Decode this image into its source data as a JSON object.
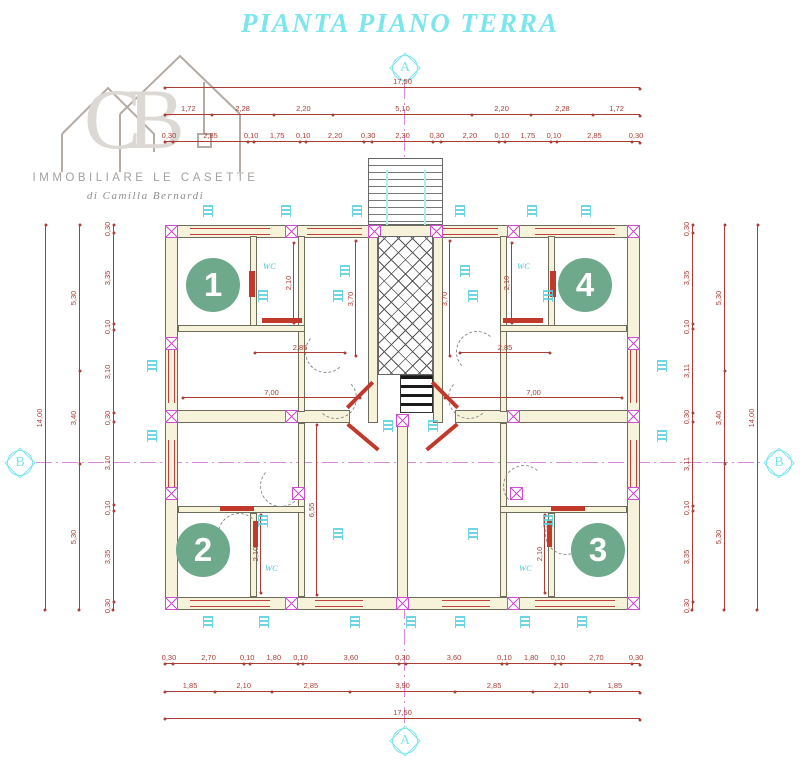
{
  "title": "PIANTA PIANO TERRA",
  "logo": {
    "monogram": "CB",
    "company": "IMMOBILIARE LE CASETTE",
    "tagline": "di Camilla Bernardi"
  },
  "markers": {
    "top": "A",
    "bottom": "A",
    "left": "B",
    "right": "B"
  },
  "units": {
    "u1": "1",
    "u2": "2",
    "u3": "3",
    "u4": "4"
  },
  "rooms": {
    "wc": "WC"
  },
  "dims": {
    "top_total": [
      "17,50"
    ],
    "top_main": [
      "1,72",
      "2,28",
      "2,20",
      "5,10",
      "2,20",
      "2,28",
      "1,72"
    ],
    "top_detail": [
      "0,30",
      "2,85",
      "0,10",
      "1,75",
      "0,10",
      "2,20",
      "0,30",
      "2,30",
      "0,30",
      "2,20",
      "0,10",
      "1,75",
      "0,10",
      "2,85",
      "0,30"
    ],
    "bottom_detail": [
      "0,30",
      "2,70",
      "0,10",
      "1,80",
      "0,10",
      "3,60",
      "0,30",
      "3,60",
      "0,10",
      "1,80",
      "0,10",
      "2,70",
      "0,30"
    ],
    "bottom_main": [
      "1,85",
      "2,10",
      "2,85",
      "3,90",
      "2,85",
      "2,10",
      "1,85"
    ],
    "bottom_total": [
      "17,50"
    ],
    "left_detail": [
      "0,30",
      "3,35",
      "0,10",
      "3,10",
      "0,30",
      "3,10",
      "0,10",
      "3,35",
      "0,30"
    ],
    "left_main": [
      "5,30",
      "3,40",
      "5,30"
    ],
    "left_total": [
      "14,00"
    ],
    "right_detail": [
      "0,30",
      "3,35",
      "0,10",
      "3,11",
      "0,30",
      "3,11",
      "0,10",
      "3,35",
      "0,30"
    ],
    "right_main": [
      "5,30",
      "3,40",
      "5,30"
    ],
    "right_total": [
      "14,00"
    ],
    "interior": {
      "room_w": "7,00",
      "hall_w": "2,85",
      "wc_w": "2,10",
      "stair_h": "3,70",
      "hall_h": "6,55"
    }
  },
  "colors": {
    "dimension_red": "#ab3d36",
    "centerline_magenta": "#d98add",
    "column_magenta": "#cf4fd0",
    "title_cyan": "#7be6ec",
    "unit_green": "#6fa98c",
    "wall_fill": "#f7f3da"
  }
}
